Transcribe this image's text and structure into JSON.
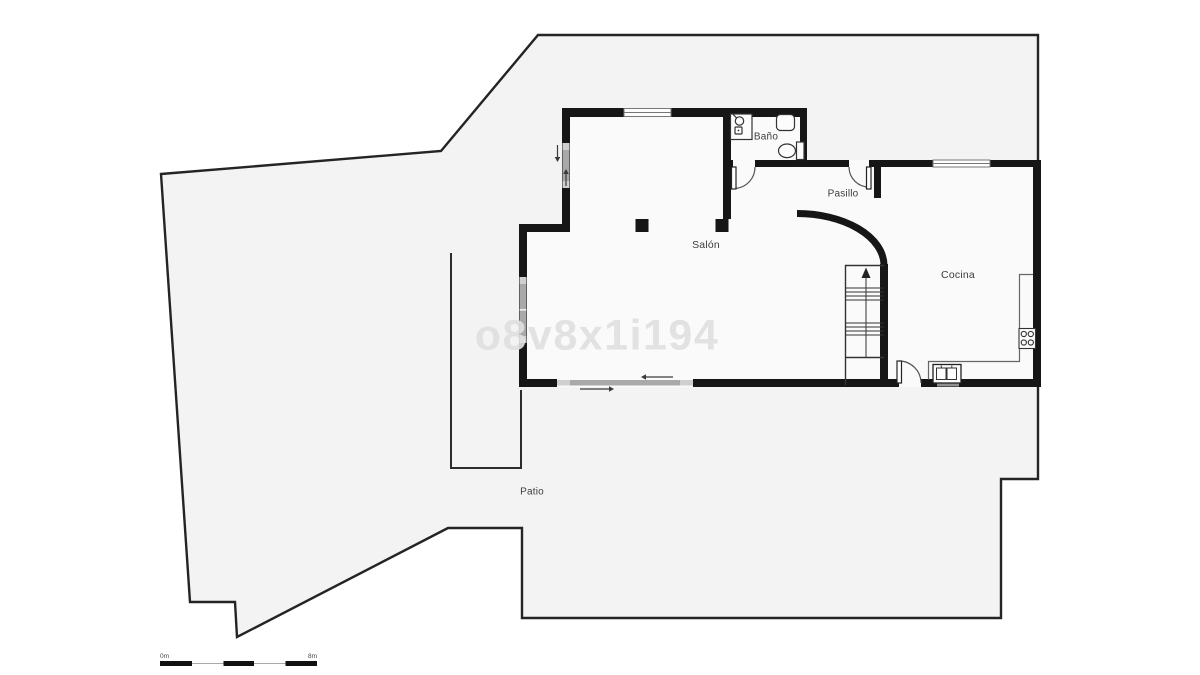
{
  "page": {
    "kind": "floor-plan-drawing",
    "background": "#ffffff"
  },
  "watermark": {
    "text": "o8v8x1i194",
    "color": "#e2e2e2"
  },
  "labels": {
    "bano": "Baño",
    "pasillo": "Pasillo",
    "salon": "Salón",
    "cocina": "Cocina",
    "patio": "Patio"
  },
  "scale_bar": {
    "start": "0m",
    "end": "8m"
  },
  "colors": {
    "wall": "#161616",
    "outline": "#242424",
    "patio_fill": "#f3f3f3",
    "interior_fill": "#fafafa",
    "window_gray": "#a9a9a9",
    "window_cap": "#cfcfcf",
    "fixture_stroke": "#333333"
  },
  "icons": {
    "fixtures": [
      "shower-icon",
      "bathroom-sink-icon",
      "toilet-icon",
      "kitchen-sink-icon",
      "stove-icon",
      "stairs-up-arrow-icon",
      "door-swing-icon",
      "sliding-door-arrow-icon"
    ]
  }
}
